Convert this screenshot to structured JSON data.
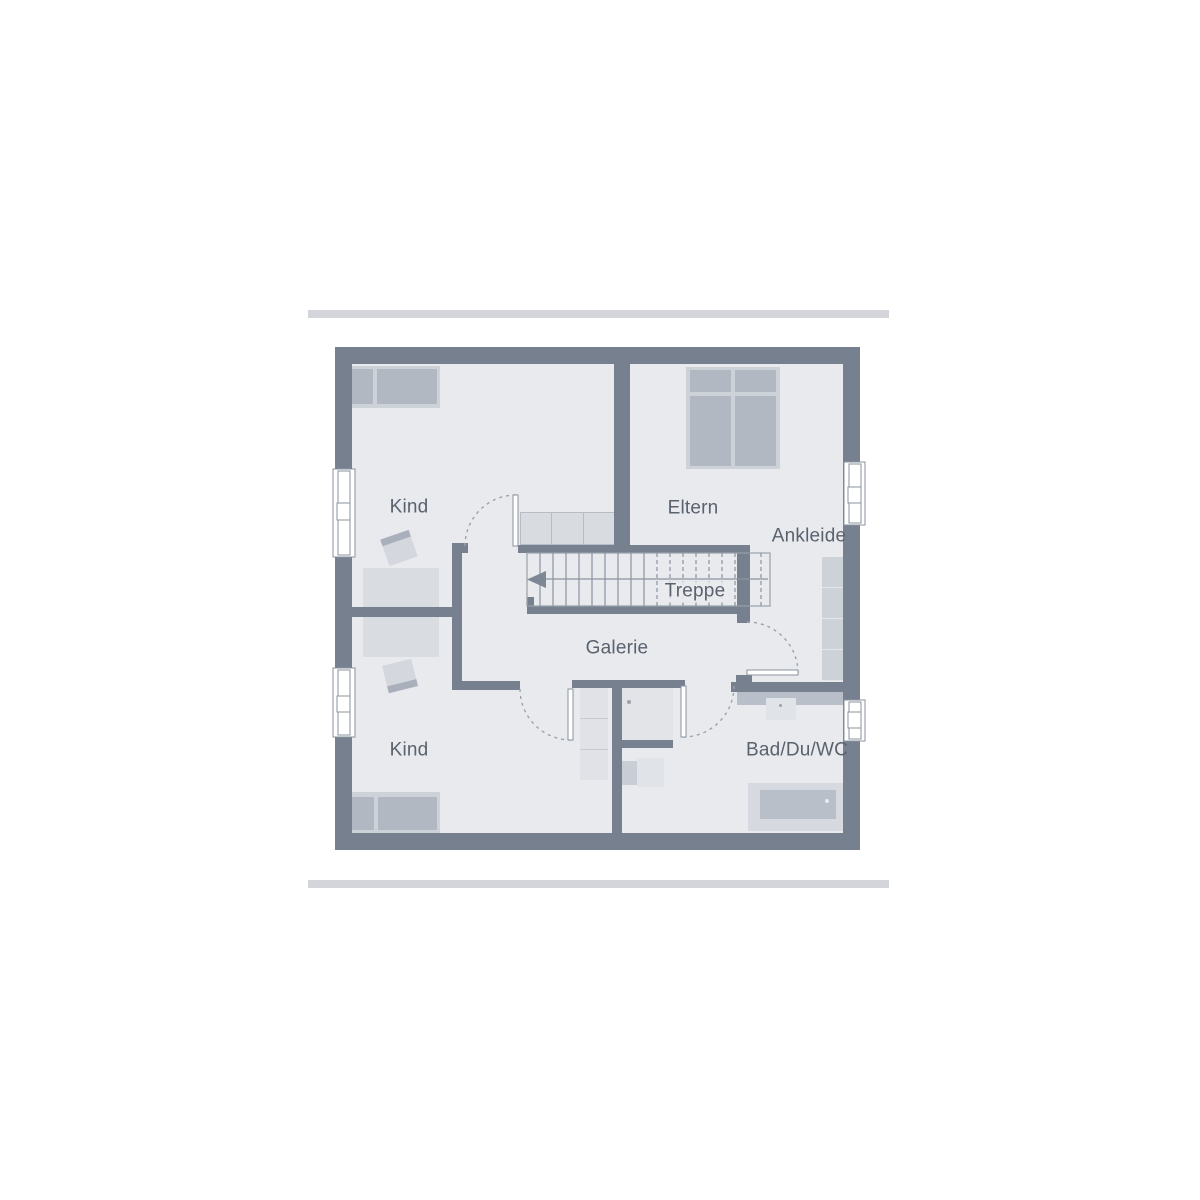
{
  "plan": {
    "type": "floor-plan-upper-storey",
    "labels": {
      "kind_top": "Kind",
      "eltern": "Eltern",
      "ankleide": "Ankleide",
      "treppe": "Treppe",
      "galerie": "Galerie",
      "kind_bottom": "Kind",
      "bad": "Bad/Du/WC"
    },
    "rooms": [
      {
        "name": "Kind",
        "position": "top-left"
      },
      {
        "name": "Eltern",
        "position": "top-right"
      },
      {
        "name": "Ankleide",
        "position": "right"
      },
      {
        "name": "Treppe",
        "position": "center"
      },
      {
        "name": "Galerie",
        "position": "center"
      },
      {
        "name": "Kind",
        "position": "bottom-left"
      },
      {
        "name": "Bad/Du/WC",
        "position": "bottom-right"
      }
    ],
    "colors": {
      "background": "#ffffff",
      "wall": "#77808e",
      "floor": "#e8eaee",
      "divider_bar": "#d3d5da",
      "furniture_dark": "#b2b8c2",
      "furniture_frame": "#cdd1d8",
      "line": "#8a93a0",
      "door_arc": "#9aa3ae",
      "label_text": "#5a626e"
    },
    "icons": {
      "stair_direction_arrow": "arrow-left"
    }
  }
}
